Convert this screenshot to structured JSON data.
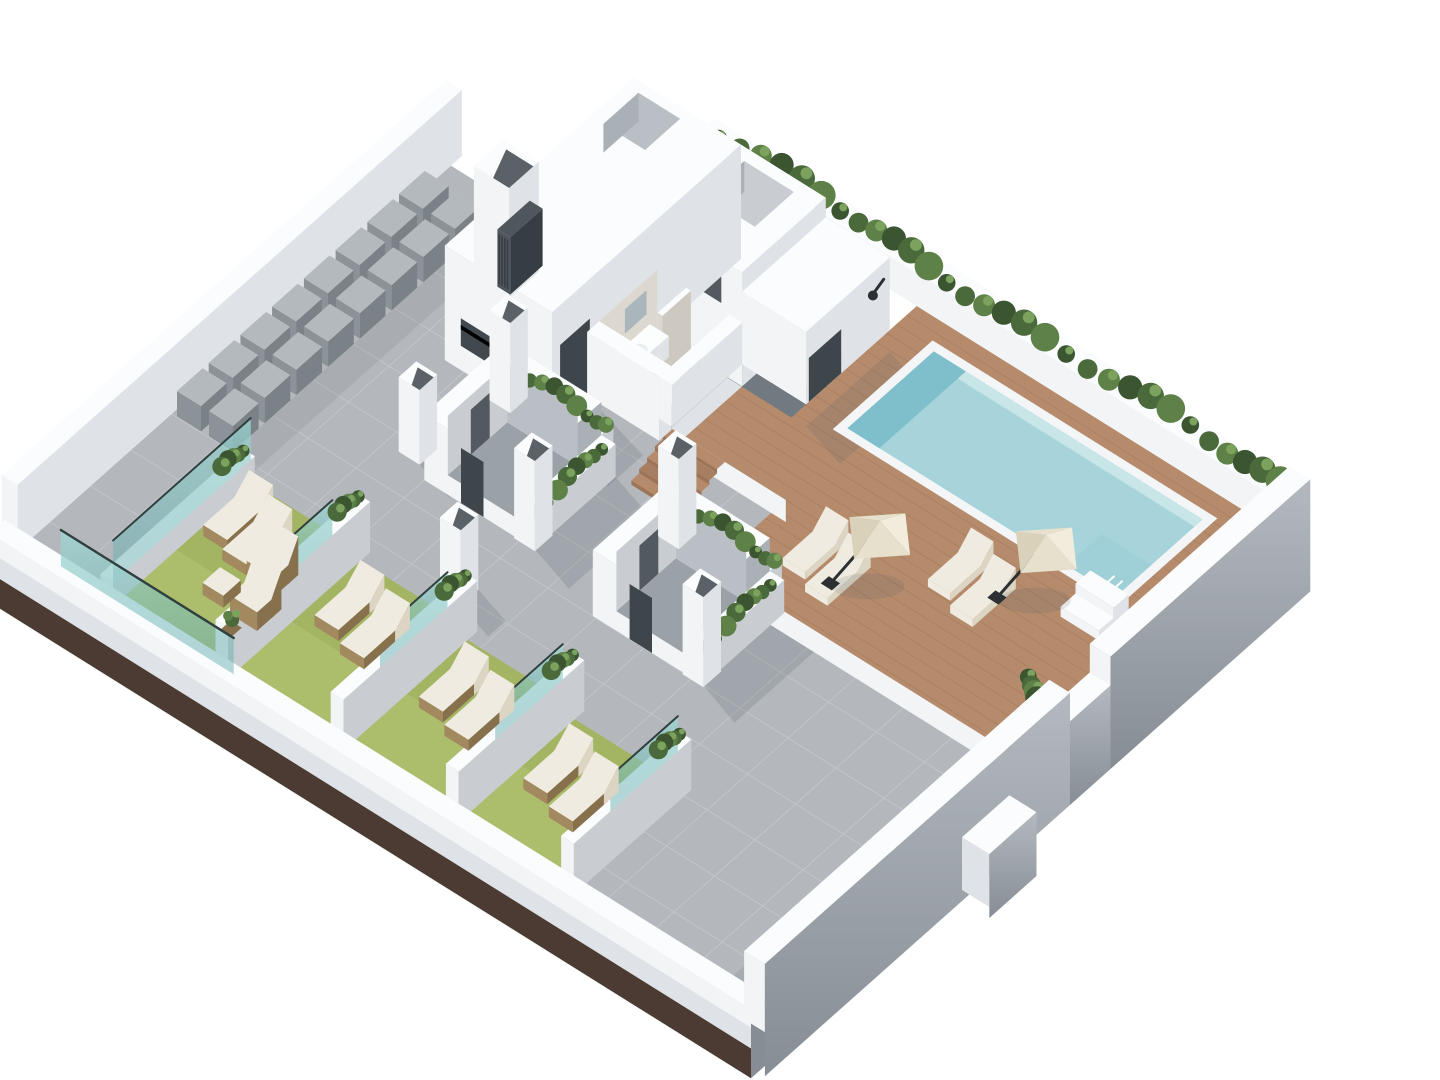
{
  "meta": {
    "title": "Rooftop terrace 3D axonometric floor-plan render",
    "background": "#ffffff",
    "canvas": {
      "width": 1440,
      "height": 1080
    }
  },
  "palette": {
    "white1": "#fbfcfd",
    "white2": "#f2f4f6",
    "white3": "#dfe3e7",
    "grayFace": "#a9b0b6",
    "grayFace2": "#c9cdd1",
    "grayFace3": "#b9bfc4",
    "floorIn": "#9aa1a7",
    "terrace": "#b4b8bc",
    "tileLine": "#c9cdd0",
    "deck": "#b58b6c",
    "deckDark": "#a87e60",
    "plank": "#8f6a4e",
    "stepRiser": "#9c7457",
    "poolRim": "#f3f5f6",
    "water": "#a7d4db",
    "waterWall": "#7fbecb",
    "waterLight": "#c8e5e8",
    "waterDeep": "#99ccd5",
    "lawn": "#a3b562",
    "lawnLight": "#b4c474",
    "hedge1": "#3b5531",
    "hedge2": "#4a6a3b",
    "hedge3": "#5d8147",
    "hedge4": "#7ca35e",
    "wicker": "#a3895f",
    "wickerDark": "#87714d",
    "cushion": "#f0ebe0",
    "cushionShade": "#dcd5c3",
    "par1": "#f2ecdd",
    "par2": "#e7e0cc",
    "par3": "#d9d1ba",
    "pole": "#2d3033",
    "acTop": "#b4b9bd",
    "acSide": "#7a8187",
    "acSide2": "#8b9298",
    "gate": "#4f565c",
    "gateSlat": "#363d43",
    "glassA": "#9fd8d4",
    "glassB": "#5fa9ab",
    "glassCap": "#31403f",
    "brown": "#4b3b33",
    "slabA": "#b3b9bf",
    "slabB": "#868d94",
    "shadow": "rgba(80,90,100,0.18)",
    "shadow2": "rgba(80,90,100,0.28)",
    "bathFloor": "#63727f",
    "marble": "#dcd8d0",
    "marble2": "#cdc9c0",
    "fixture": "#fcfdfd",
    "mirror": "#a9b6bc",
    "doorDark": "#3e454b",
    "windowDark": "#41484e",
    "notch": "#5a6167",
    "slate": "#6a7884"
  },
  "scene": {
    "items": [
      {
        "id": "building-core",
        "label": "stair and utility core"
      },
      {
        "id": "bathroom",
        "label": "bathroom with toilet and washbasin"
      },
      {
        "id": "outdoor-shower",
        "label": "outdoor shower fixture"
      },
      {
        "id": "swimming-pool",
        "label": "swimming pool"
      },
      {
        "id": "pool-deck",
        "label": "timber pool deck"
      },
      {
        "id": "deck-steps",
        "label": "timber steps to pool deck"
      },
      {
        "id": "pool-entry-steps",
        "label": "white pool entry steps"
      },
      {
        "id": "perimeter-hedge",
        "label": "perimeter hedge planter"
      },
      {
        "id": "parasols",
        "label": "parasols with sun loungers"
      },
      {
        "id": "skylight-court-1",
        "label": "courtyard light well"
      },
      {
        "id": "skylight-court-2",
        "label": "courtyard light well"
      },
      {
        "id": "hvac-units",
        "label": "rooftop HVAC units"
      },
      {
        "id": "vent-chimney",
        "label": "ventilation chimney"
      },
      {
        "id": "louvre-gate",
        "label": "dark louvre service gate"
      },
      {
        "id": "lawn-terraces",
        "label": "private lawn terraces with wicker loungers"
      },
      {
        "id": "glass-screens",
        "label": "teal glass privacy screens"
      },
      {
        "id": "planter-pillars",
        "label": "white planter pillars"
      },
      {
        "id": "parapet-walls",
        "label": "white parapet walls"
      },
      {
        "id": "main-terrace",
        "label": "grey tiled terrace"
      }
    ]
  }
}
